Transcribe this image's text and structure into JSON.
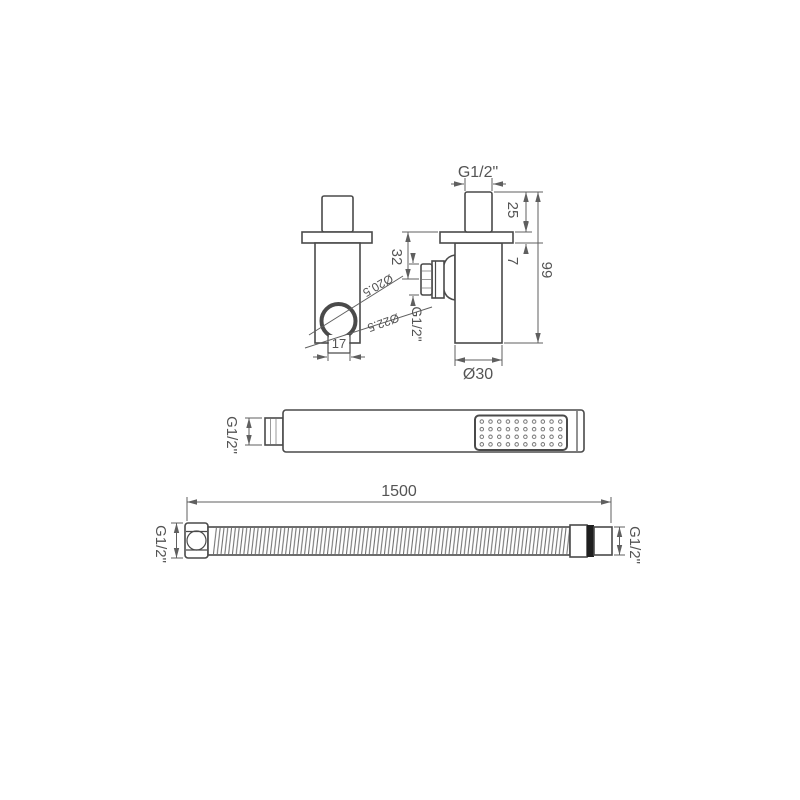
{
  "colors": {
    "line": "#4a4a4a",
    "dimension": "#5f5f5f",
    "text": "#545454",
    "hose_band": "#1f1f1f",
    "background": "#ffffff"
  },
  "wall_outlet": {
    "front": {
      "holder_inner_dia": "Ø20.5",
      "holder_outer_dia": "Ø22.5",
      "holder_width": "17"
    },
    "side": {
      "inlet_thread": "G1/2\"",
      "stub_height": "25",
      "flange_thickness": "7",
      "total_height": "99",
      "outlet_offset": "32",
      "outlet_thread": "G1/2\"",
      "body_dia": "Ø30"
    }
  },
  "hand_shower": {
    "inlet_thread": "G1/2\""
  },
  "hose": {
    "length": "1500",
    "left_thread": "G1/2\"",
    "right_thread": "G1/2\""
  }
}
